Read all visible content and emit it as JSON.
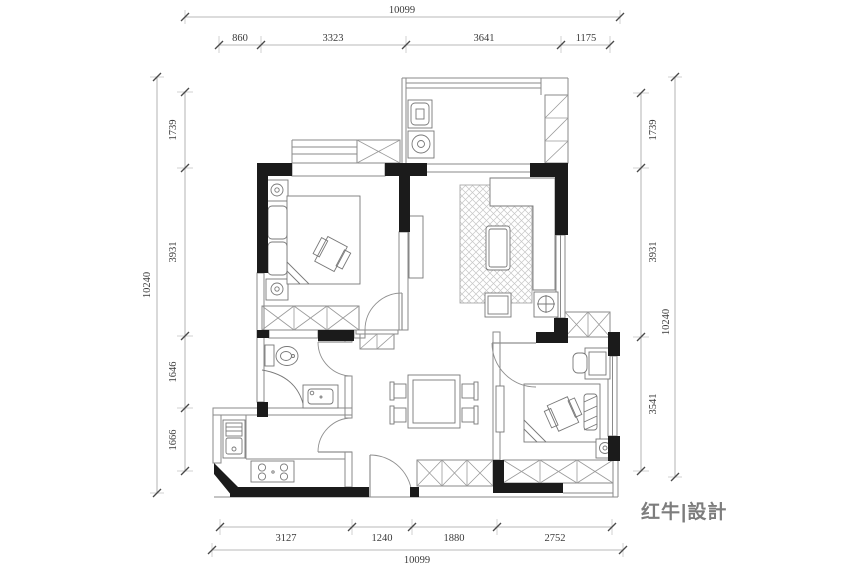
{
  "dimensions": {
    "top": {
      "overall": "10099",
      "segments": [
        "860",
        "3323",
        "3641",
        "1175"
      ]
    },
    "bottom": {
      "overall": "10099",
      "segments": [
        "3127",
        "1240",
        "1880",
        "2752"
      ]
    },
    "left": {
      "overall": "10240",
      "segments": [
        "1739",
        "3931",
        "1646",
        "1666"
      ]
    },
    "right": {
      "overall": "10240",
      "segments": [
        "1739",
        "3931",
        "3541"
      ]
    }
  },
  "logo": {
    "text": "红牛|設計"
  },
  "colors": {
    "background": "#ffffff",
    "wall": "#1b1b1b",
    "line": "#8a8a8a",
    "dim_line": "#a0a0a0",
    "dim_text": "#3a3a3a",
    "hatch": "#c6c6c6"
  },
  "fixtures": [
    "double-bed",
    "pillow",
    "nightstand-lamp",
    "wardrobe-x-cabinet",
    "bay-window",
    "l-sofa",
    "rug",
    "coffee-table",
    "tv-cabinet",
    "stool",
    "side-table-crosshair",
    "dining-table",
    "dining-chair",
    "shoe-cabinet",
    "toilet",
    "shower-curtain",
    "vanity-sink",
    "kitchen-sink",
    "gas-stove",
    "washing-machine",
    "laundry-unit",
    "ac-platform-hatch",
    "door-swing",
    "window",
    "balcony-cabinet",
    "desk-and-chair"
  ]
}
